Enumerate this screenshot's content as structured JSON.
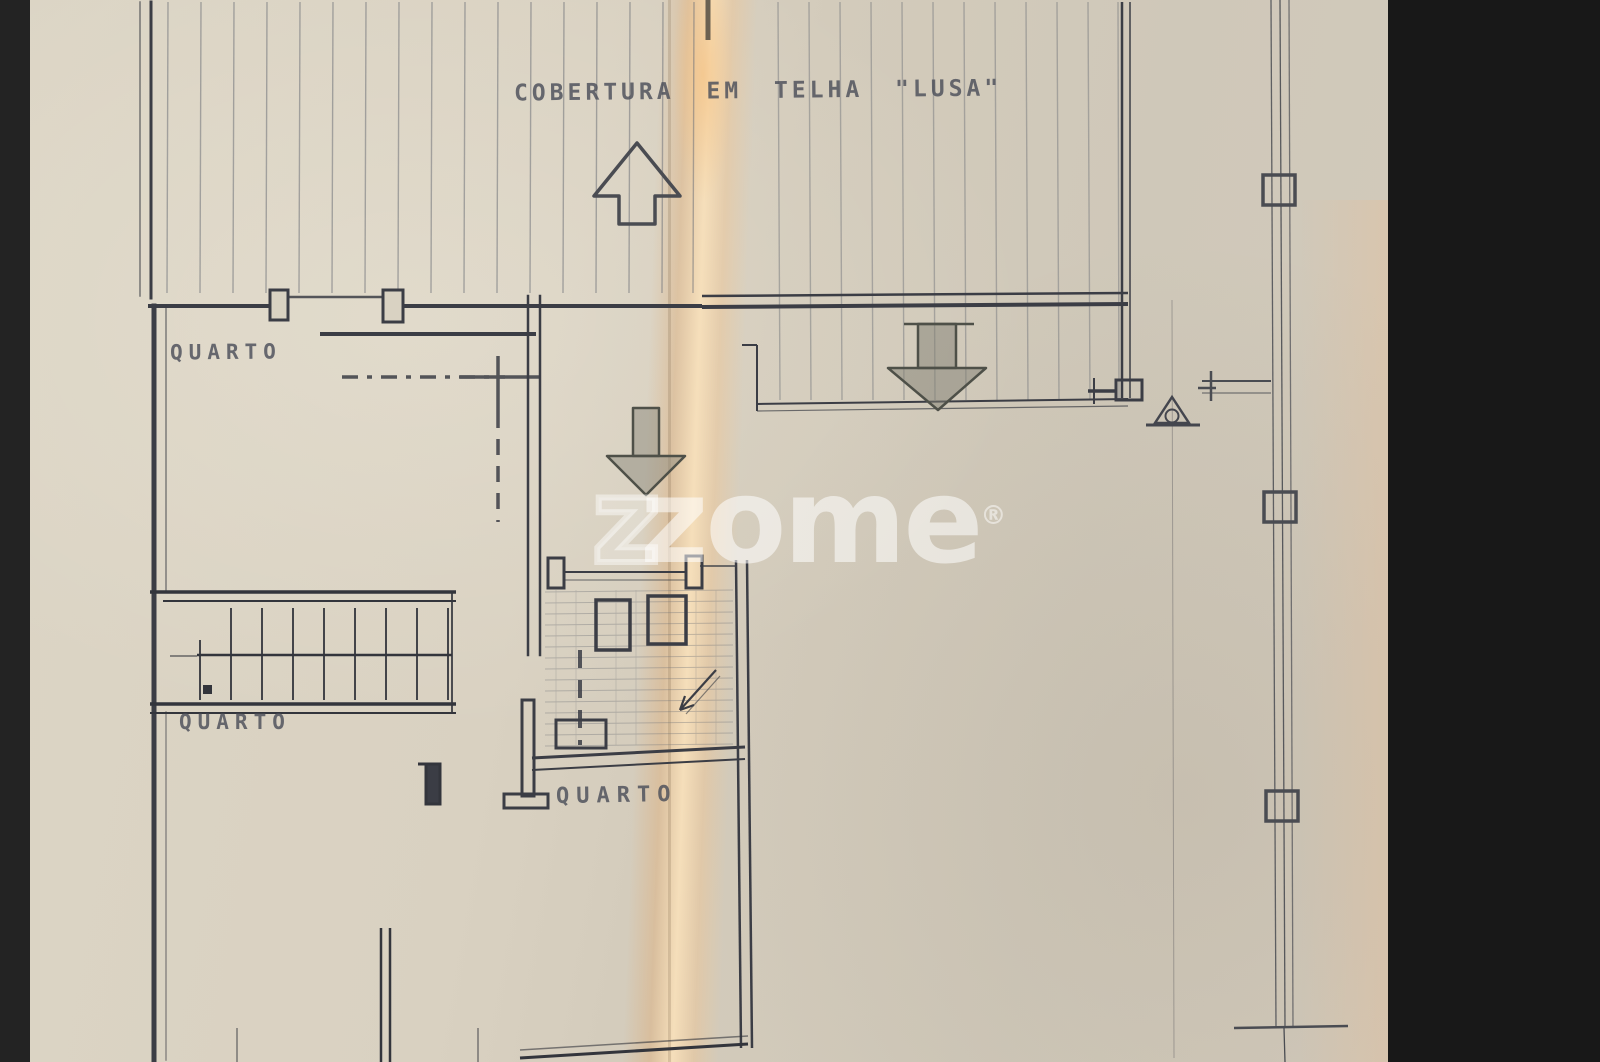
{
  "photo": {
    "description": "Photographed hand-drawn architectural floor plan on aged folded paper",
    "annotations": {
      "roof_note": "COBERTURA EM TELHA \"LUSA\"",
      "rooms": [
        {
          "label": "QUARTO"
        },
        {
          "label": "QUARTO"
        },
        {
          "label": "QUARTO"
        }
      ]
    },
    "watermark": {
      "outline_letter": "z",
      "text": "zome",
      "registered_mark": "®"
    },
    "colors": {
      "letterbox": "#1b1b1b",
      "paper": "#d8d1c1",
      "paper_right": "#cfc8b9",
      "fold_highlight": "#f3d7ab",
      "ink": "#3b3d45",
      "hatch": "#6f7278",
      "lettering": "#4c4f5a",
      "watermark": "rgba(255,255,255,0.55)"
    }
  }
}
